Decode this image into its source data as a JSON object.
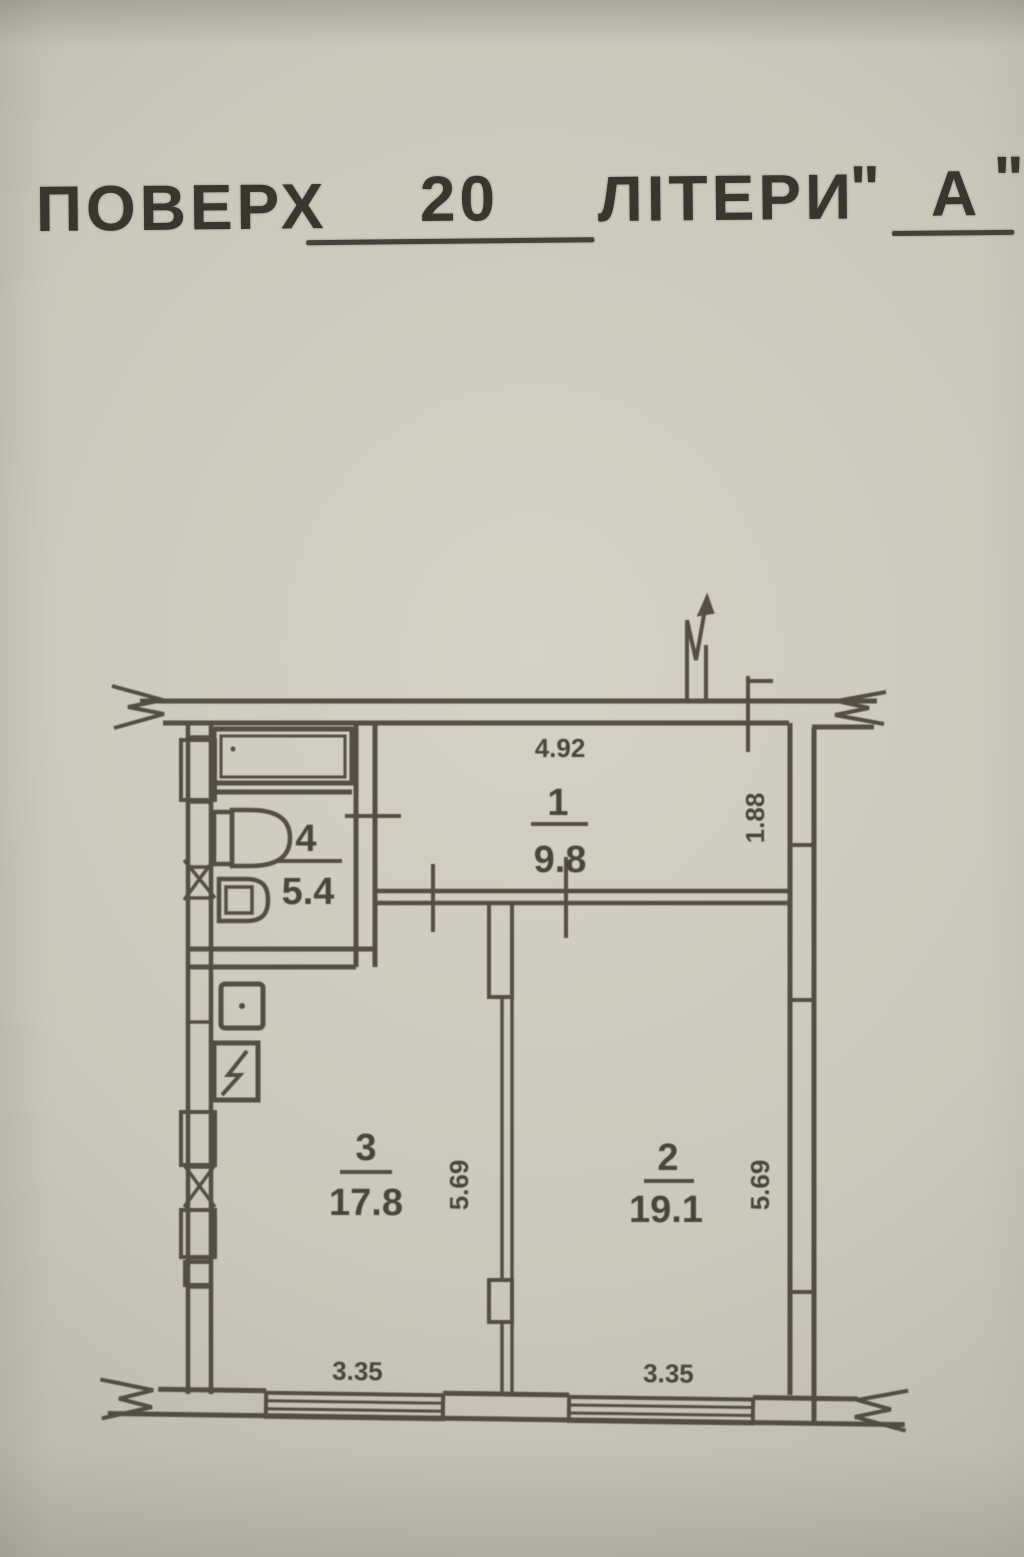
{
  "document": {
    "header": {
      "floor_label": "ПОВЕРХ",
      "floor_value": "20",
      "letters_label": "ЛІТЕРИ",
      "open_quote": "\"",
      "letters_value": "А",
      "close_quote": "\""
    },
    "plan": {
      "room1": {
        "number": "1",
        "area": "9.8",
        "width_dim": "4.92"
      },
      "room2": {
        "number": "2",
        "area": "19.1",
        "depth_dim": "5.69"
      },
      "room3": {
        "number": "3",
        "area": "17.8",
        "depth_dim": "5.69"
      },
      "room4": {
        "number": "4",
        "area": "5.4"
      },
      "right_wall_dim": "1.88",
      "window_left_dim": "3.35",
      "window_right_dim": "3.35"
    },
    "colors": {
      "paper": "#c9c5b8",
      "ink": "#49443a"
    }
  }
}
